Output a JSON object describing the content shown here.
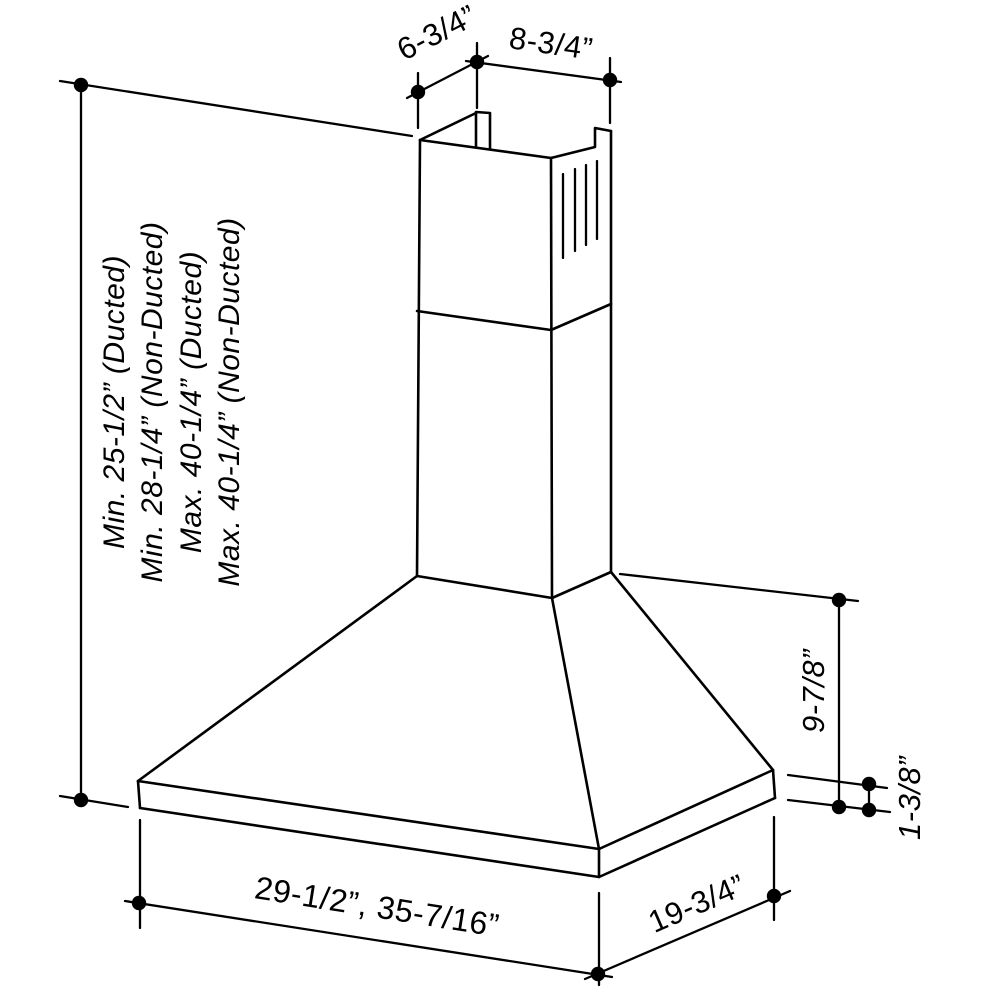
{
  "diagram": {
    "subject": "wall-mount chimney range hood isometric dimension drawing",
    "colors": {
      "line": "#000000",
      "background": "#ffffff"
    },
    "dims": {
      "chimney_depth": "6-3/4”",
      "chimney_width": "8-3/4”",
      "height_lines": [
        "Min. 25-1/2” (Ducted)",
        "Min. 28-1/4” (Non-Ducted)",
        "Max. 40-1/4” (Ducted)",
        "Max. 40-1/4” (Non-Ducted)"
      ],
      "hood_height": "9-7/8”",
      "lip_height": "1-3/8”",
      "hood_widths": "29-1/2”, 35-7/16”",
      "hood_depth": "19-3/4”"
    }
  }
}
